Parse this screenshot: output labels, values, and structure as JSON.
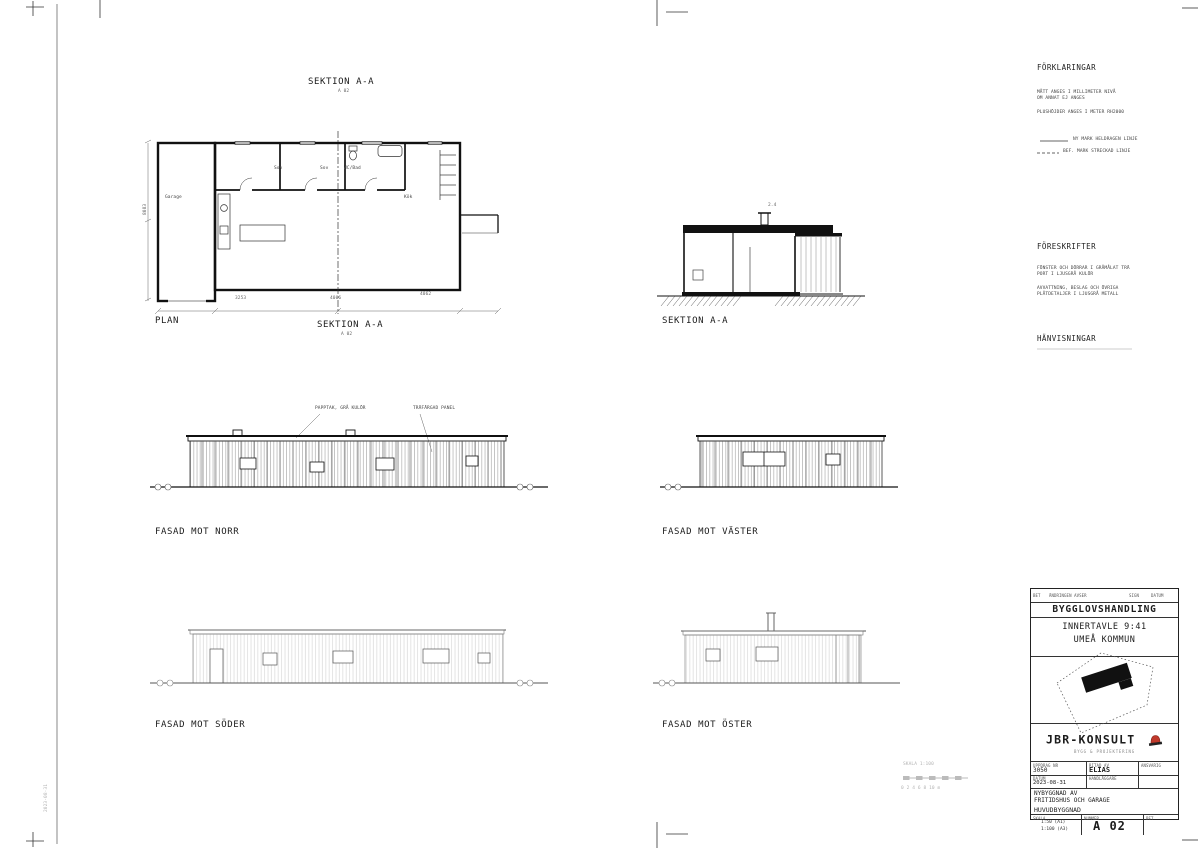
{
  "sheet": {
    "doc_type": "BYGGLOVSHANDLING",
    "property": "INNERTAVLE 9:41",
    "municipality": "UMEÅ KOMMUN",
    "drawing_number": "A 02"
  },
  "labels": {
    "section_top": "SEKTION A-A",
    "section_top_ref": "A 02",
    "plan": "PLAN",
    "section_mid": "SEKTION A-A",
    "section_mid_ref": "A 02",
    "section_right": "SEKTION A-A",
    "fasad_norr": "FASAD MOT NORR",
    "fasad_vaster": "FASAD MOT VÄSTER",
    "fasad_soder": "FASAD MOT SÖDER",
    "fasad_oster": "FASAD MOT ÖSTER"
  },
  "annotations": {
    "roof": "PAPPTAK, GRÅ KULÖR",
    "panel": "TRÄFÄRGAD PANEL",
    "section_dim": "2.4"
  },
  "plan": {
    "rooms": [
      {
        "label": "Garage"
      },
      {
        "label": "Sov"
      },
      {
        "label": "Sov"
      },
      {
        "label": "WC/Bad"
      },
      {
        "label": "Kök"
      }
    ],
    "dims": {
      "bottom1": "3253",
      "bottom2": "4006",
      "bottom3": "4062",
      "left": "8083"
    }
  },
  "notes": {
    "forklaringar": {
      "title": "FÖRKLARINGAR",
      "note1a": "MÅTT ANGES I MILLIMETER NIVÅ",
      "note1b": "OM ANNAT EJ ANGES",
      "note2": "PLUSHÖJDER ANGES I METER RH2000",
      "legend1": "NY MARK HELDRAGEN LINJE",
      "legend2": "BEF. MARK STRECKAD LINJE"
    },
    "foreskrifter": {
      "title": "FÖRESKRIFTER",
      "note1a": "FÖNSTER OCH DÖRRAR I GRÅMÅLAT TRÄ",
      "note1b": "PORT I LJUSGRÅ KULÖR",
      "note2a": "AVVATTNING, BESLAG OCH ÖVRIGA",
      "note2b": "PLÅTDETALJER I LJUSGRÅ METALL"
    },
    "hanvisningar": {
      "title": "HÄNVISNINGAR"
    }
  },
  "titleblock": {
    "rev": {
      "bet": "BET",
      "andring": "ÄNDRINGEN AVSER",
      "sign": "SIGN",
      "datum": "DATUM"
    },
    "company": "JBR-KONSULT",
    "tagline": "BYGG & PROJEKTERING",
    "fields": {
      "uppdrag_label": "UPPDRAG NR",
      "uppdrag": "3050",
      "ritad_label": "RITAD AV",
      "ritad": "ELIAS",
      "ansvarig_label": "ANSVARIG",
      "datum_label": "DATUM",
      "datum": "2023-08-31",
      "handlaggare_label": "HANDLÄGGARE"
    },
    "project_line1": "NYBYGGNAD AV",
    "project_line2": "FRITIDSHUS OCH GARAGE",
    "content": "HUVUDBYGGNAD",
    "skala_label": "SKALA",
    "skala1": "1:50 (A1)",
    "skala2": "1:100 (A3)",
    "nummer_label": "NUMMER",
    "nummer": "A 02",
    "bet_label": "BET"
  },
  "misc": {
    "scalebar_title": "SKALA 1:100",
    "scalebar_ticks": "0   2   4   6   8   10 m",
    "plot_stamp": "2023-08-31"
  }
}
